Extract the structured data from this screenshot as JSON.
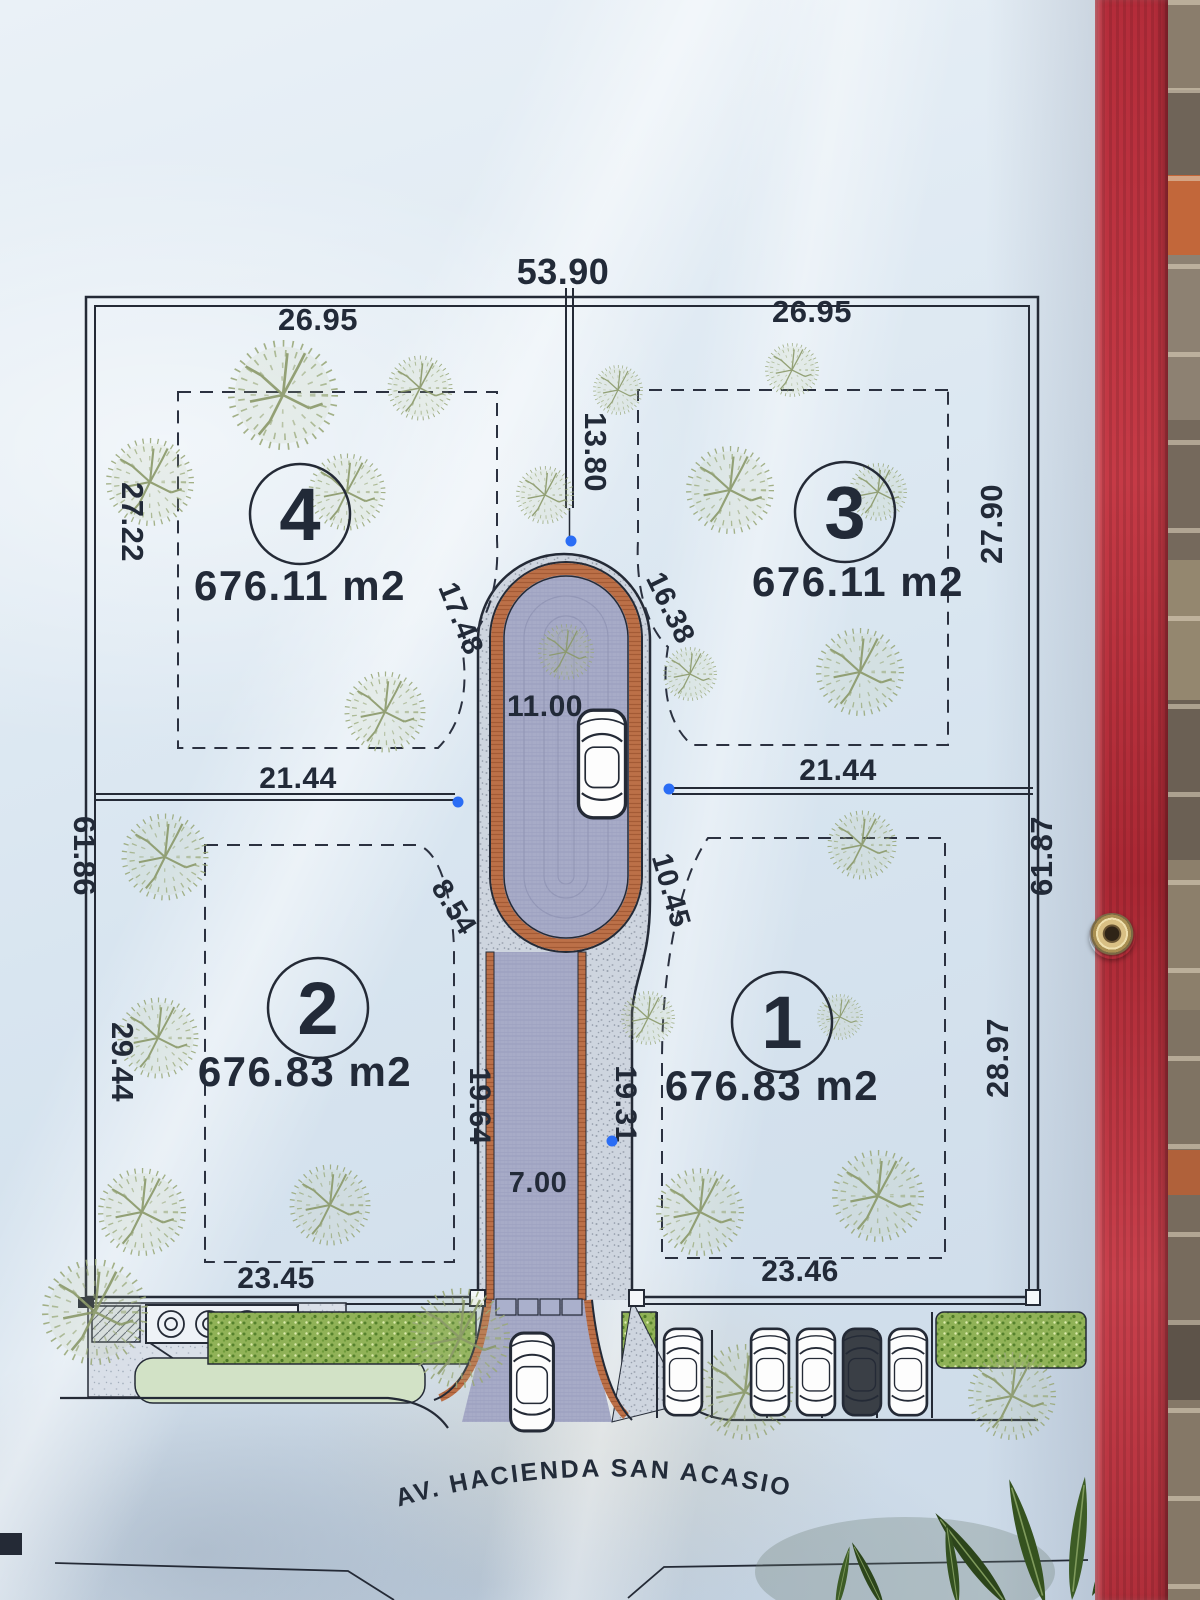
{
  "photo": {
    "description": "printed lot-subdivision site plan on a vinyl banner hung on a brick wall",
    "banner_color": "#e8f0f6",
    "edge_band_color": "#b82e3c",
    "grommet_color": "#d9c084"
  },
  "plan": {
    "street_name": "AV. HACIENDA SAN ACASIO",
    "lots": [
      {
        "number": "1",
        "area": "676.83 m2"
      },
      {
        "number": "2",
        "area": "676.83 m2"
      },
      {
        "number": "3",
        "area": "676.11 m2"
      },
      {
        "number": "4",
        "area": "676.11 m2"
      }
    ],
    "dims": {
      "top_total": "53.90",
      "top_left": "26.95",
      "top_right": "26.95",
      "divider": "13.80",
      "side_upper_left": "27.22",
      "side_upper_right": "27.90",
      "side_left_total": "61.86",
      "side_right_total": "61.87",
      "side_lower_left": "29.44",
      "side_lower_right": "28.97",
      "mid_left": "21.44",
      "mid_right": "21.44",
      "cul_left": "17.48",
      "cul_right": "16.38",
      "cul_width": "11.00",
      "curve_left": "8.54",
      "curve_right": "10.45",
      "drive_left": "19.64",
      "drive_right": "19.31",
      "drive_width": "7.00",
      "bottom_left": "23.45",
      "bottom_right": "23.46"
    },
    "colors": {
      "ink": "#242a36",
      "paver": "#a7abc7",
      "curb": "#bc7048",
      "hedge": "#90b257",
      "tree": "#9aa97a",
      "road": "#ced5df",
      "marker_dot": "#2a6df5"
    }
  }
}
